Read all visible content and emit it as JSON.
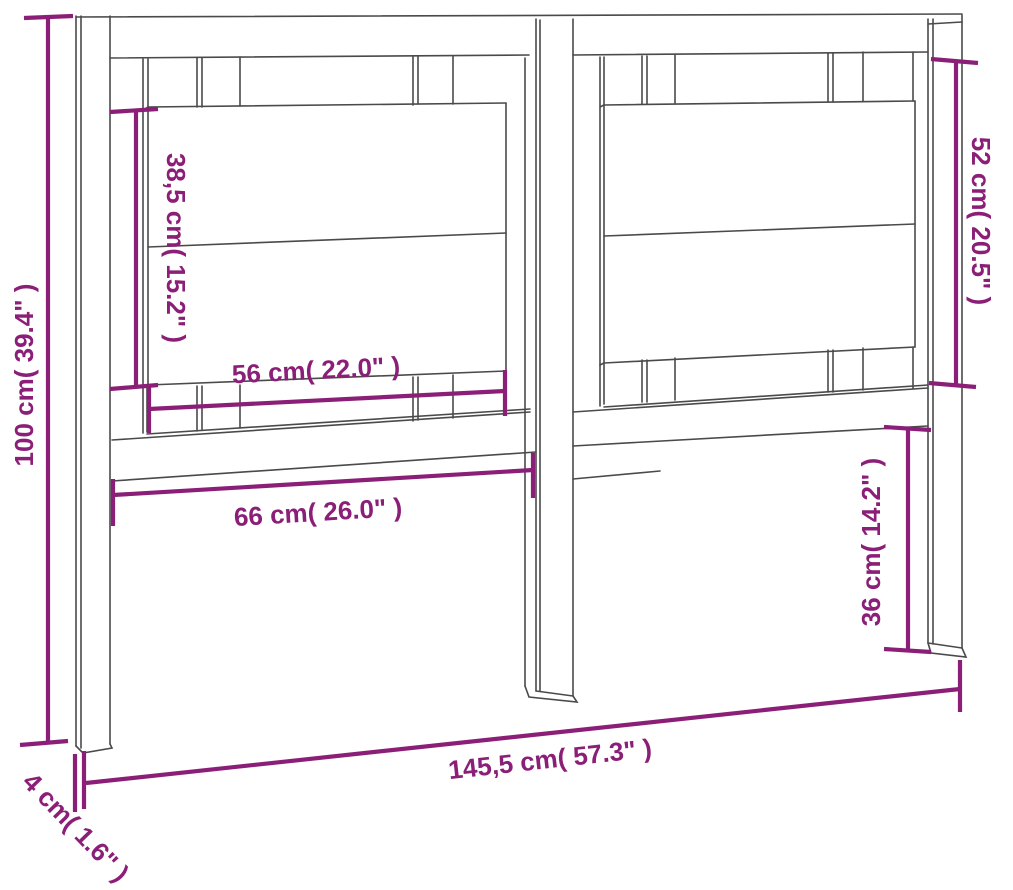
{
  "diagram": {
    "subject": "Bed headboard dimension drawing",
    "background_color": "#ffffff",
    "line_art_color": "#4a4a4a",
    "dimension_color": "#8b1f78",
    "dimensions": {
      "total_height": {
        "label": "100 cm( 39.4\" )",
        "cm": "100",
        "inches": "39.4"
      },
      "left_panel_height": {
        "label": "38,5 cm( 15.2\" )",
        "cm": "38,5",
        "inches": "15.2"
      },
      "right_panel_height": {
        "label": "52 cm( 20.5\" )",
        "cm": "52",
        "inches": "20.5"
      },
      "left_panel_width": {
        "label": "56 cm( 22.0\" )",
        "cm": "56",
        "inches": "22.0"
      },
      "opening_width": {
        "label": "66 cm( 26.0\" )",
        "cm": "66",
        "inches": "26.0"
      },
      "leg_height": {
        "label": "36 cm( 14.2\" )",
        "cm": "36",
        "inches": "14.2"
      },
      "total_width": {
        "label": "145,5 cm( 57.3\" )",
        "cm": "145,5",
        "inches": "57.3"
      },
      "post_depth": {
        "label": "4 cm( 1.6\" )",
        "cm": "4",
        "inches": "1.6"
      }
    }
  }
}
